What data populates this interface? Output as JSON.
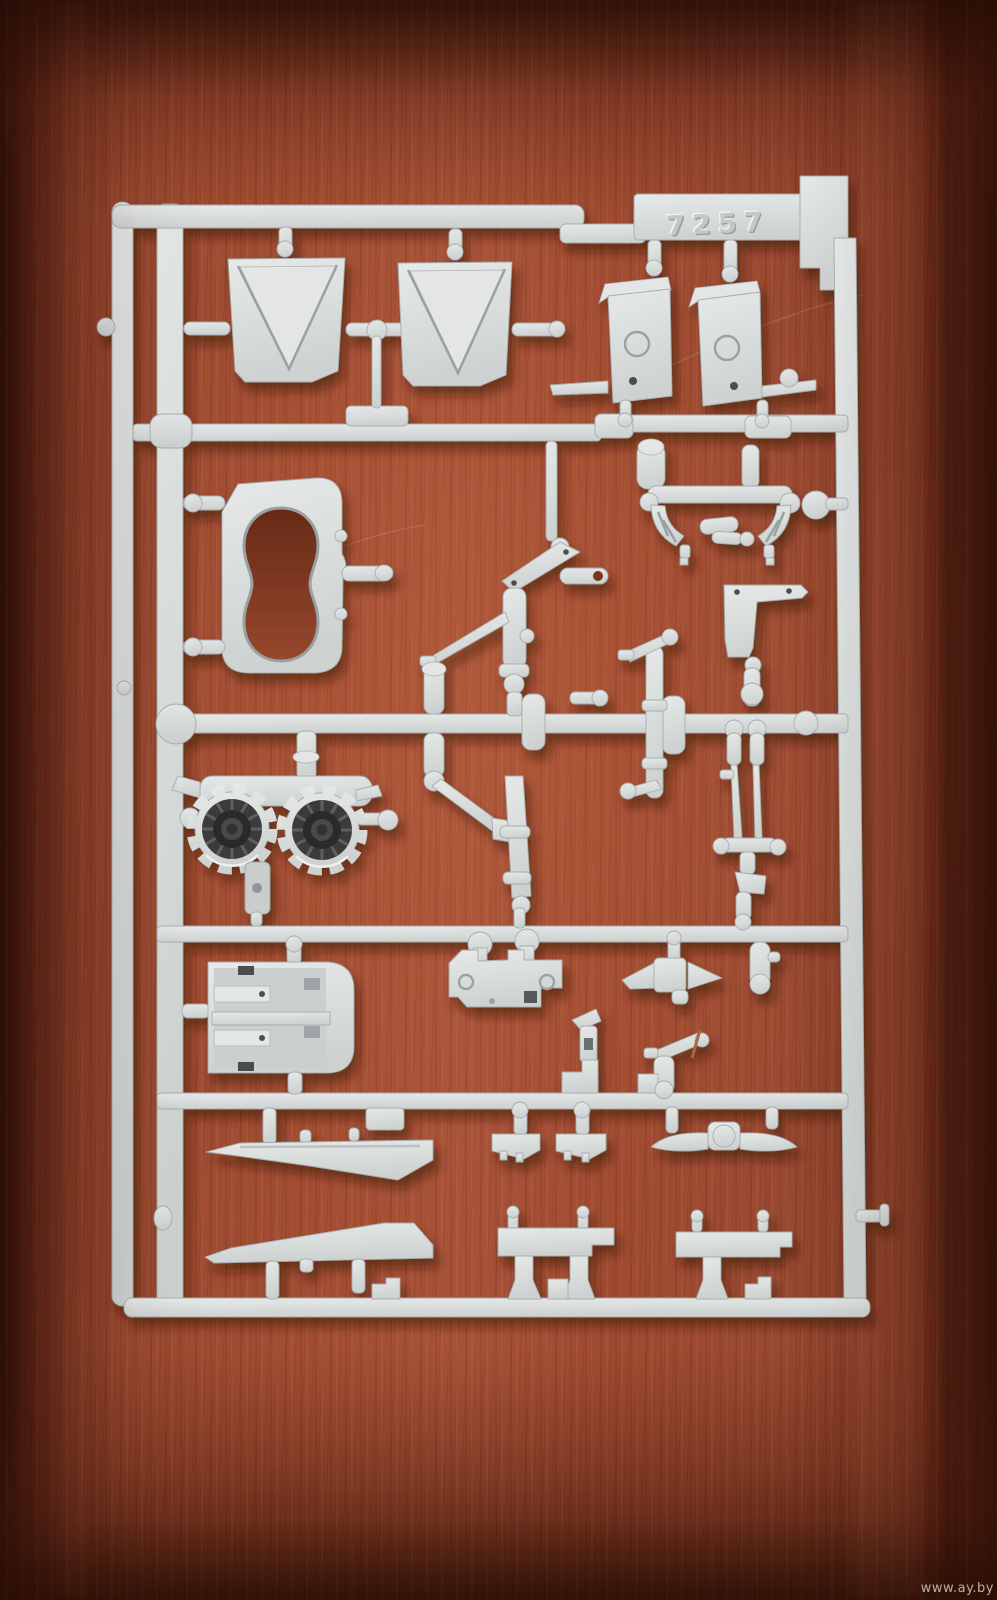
{
  "scene": {
    "type": "photograph",
    "subject": "Light gray injection-molded plastic model kit sprue (parts tree) photographed on a reddish-brown wooden table",
    "mold_number": "7257",
    "watermark": "www.ay.by",
    "colors": {
      "wood_midtone": "#a04b31",
      "wood_shadow": "#431c0c",
      "wood_highlight": "#c1744f",
      "plastic_light": "#e3e6e5",
      "plastic_base": "#d5d9d8",
      "plastic_shade": "#aeb4b5",
      "turbine_dark": "#363636"
    },
    "parts_visible": [
      "rectangular sprue frame with horizontal runners",
      "two triangular intake ramp panels",
      "two intake trunk boxes with embossed rings",
      "curved exhaust housing with peanut-shaped cutout",
      "twin scalloped engine nozzles with dark turbine faces",
      "cockpit tub with console ledges",
      "landing gear struts and actuator linkages",
      "curved ring-segment cluster",
      "mount bracket with twin pins",
      "two long tapered wing strakes",
      "two step rails with T-posts",
      "assorted small clips, vanes and gate pins"
    ]
  }
}
